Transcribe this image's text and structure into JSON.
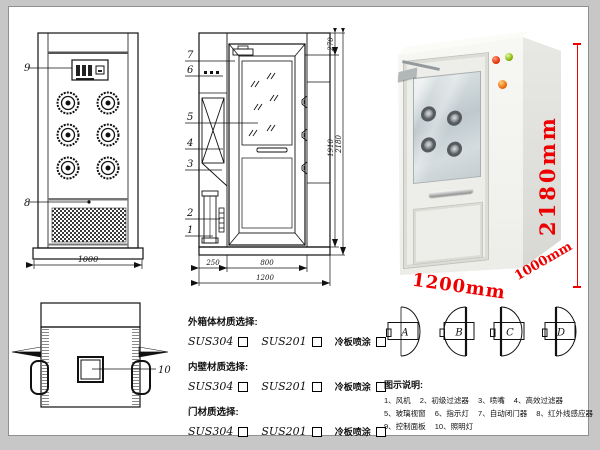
{
  "colors": {
    "accent_red": "#ee0000",
    "line": "#111111"
  },
  "front_view": {
    "callout_top": "9",
    "callout_bottom": "8",
    "width_dim": "1000"
  },
  "plan_view": {
    "callout": "10"
  },
  "side_view": {
    "callouts": [
      "7",
      "6",
      "5",
      "4",
      "3",
      "2",
      "1"
    ],
    "dim_left_bottom": "250",
    "dim_door_bottom": "800",
    "dim_total_bottom": "1200",
    "dim_top_right": "270",
    "dim_body_height": "1910",
    "dim_total_height": "2180"
  },
  "photo": {
    "height_label": "2180mm",
    "width_label": "1200mm",
    "depth_label": "1000mm"
  },
  "materials": {
    "sections": [
      {
        "title": "外箱体材质选择:",
        "options": [
          "SUS304",
          "SUS201",
          "冷板喷涂"
        ]
      },
      {
        "title": "内壁材质选择:",
        "options": [
          "SUS304",
          "SUS201",
          "冷板喷涂"
        ]
      },
      {
        "title": "门材质选择:",
        "options": [
          "SUS304",
          "SUS201",
          "冷板喷涂"
        ]
      }
    ]
  },
  "door_options": {
    "labels": [
      "A",
      "B",
      "C",
      "D"
    ]
  },
  "legend": {
    "title": "图示说明:",
    "items": [
      "1、风机",
      "2、初级过滤器",
      "3、喷嘴",
      "4、高效过滤器",
      "5、玻璃视窗",
      "6、指示灯",
      "7、自动闭门器",
      "8、红外线感应器",
      "9、控制面板",
      "10、照明灯"
    ]
  }
}
